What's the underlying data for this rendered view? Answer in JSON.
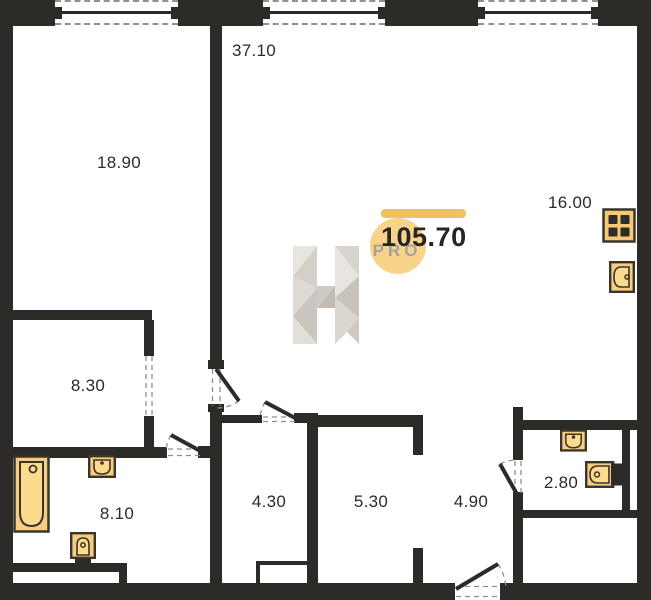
{
  "plan": {
    "total_area": "105.70",
    "watermark_badge": "PRO",
    "watermark_logo": "h-logo-watermark",
    "rooms": [
      {
        "name": "living-room",
        "area": "37.10"
      },
      {
        "name": "bedroom",
        "area": "18.90"
      },
      {
        "name": "kitchen",
        "area": "16.00"
      },
      {
        "name": "room-small",
        "area": "8.30"
      },
      {
        "name": "bathroom",
        "area": "8.10"
      },
      {
        "name": "hall-a",
        "area": "4.30"
      },
      {
        "name": "hall-b",
        "area": "5.30"
      },
      {
        "name": "corridor",
        "area": "4.90"
      },
      {
        "name": "wc",
        "area": "2.80"
      }
    ],
    "fixtures": [
      "bathtub-icon",
      "sink-icon",
      "toilet-icon",
      "stove-icon",
      "kitchen-sink-icon",
      "wc-sink-icon",
      "wc-toilet-icon"
    ],
    "colors": {
      "wall": "#2d2b28",
      "fixture_fill": "#f6cd83",
      "fixture_fill_light": "#fcda8e",
      "fixture_stroke": "#3a342b",
      "accent_bar": "#eec263",
      "accent_circle": "#f7d48a",
      "watermark_grey": "#d6d1cb",
      "dash_grey": "#919191"
    }
  }
}
